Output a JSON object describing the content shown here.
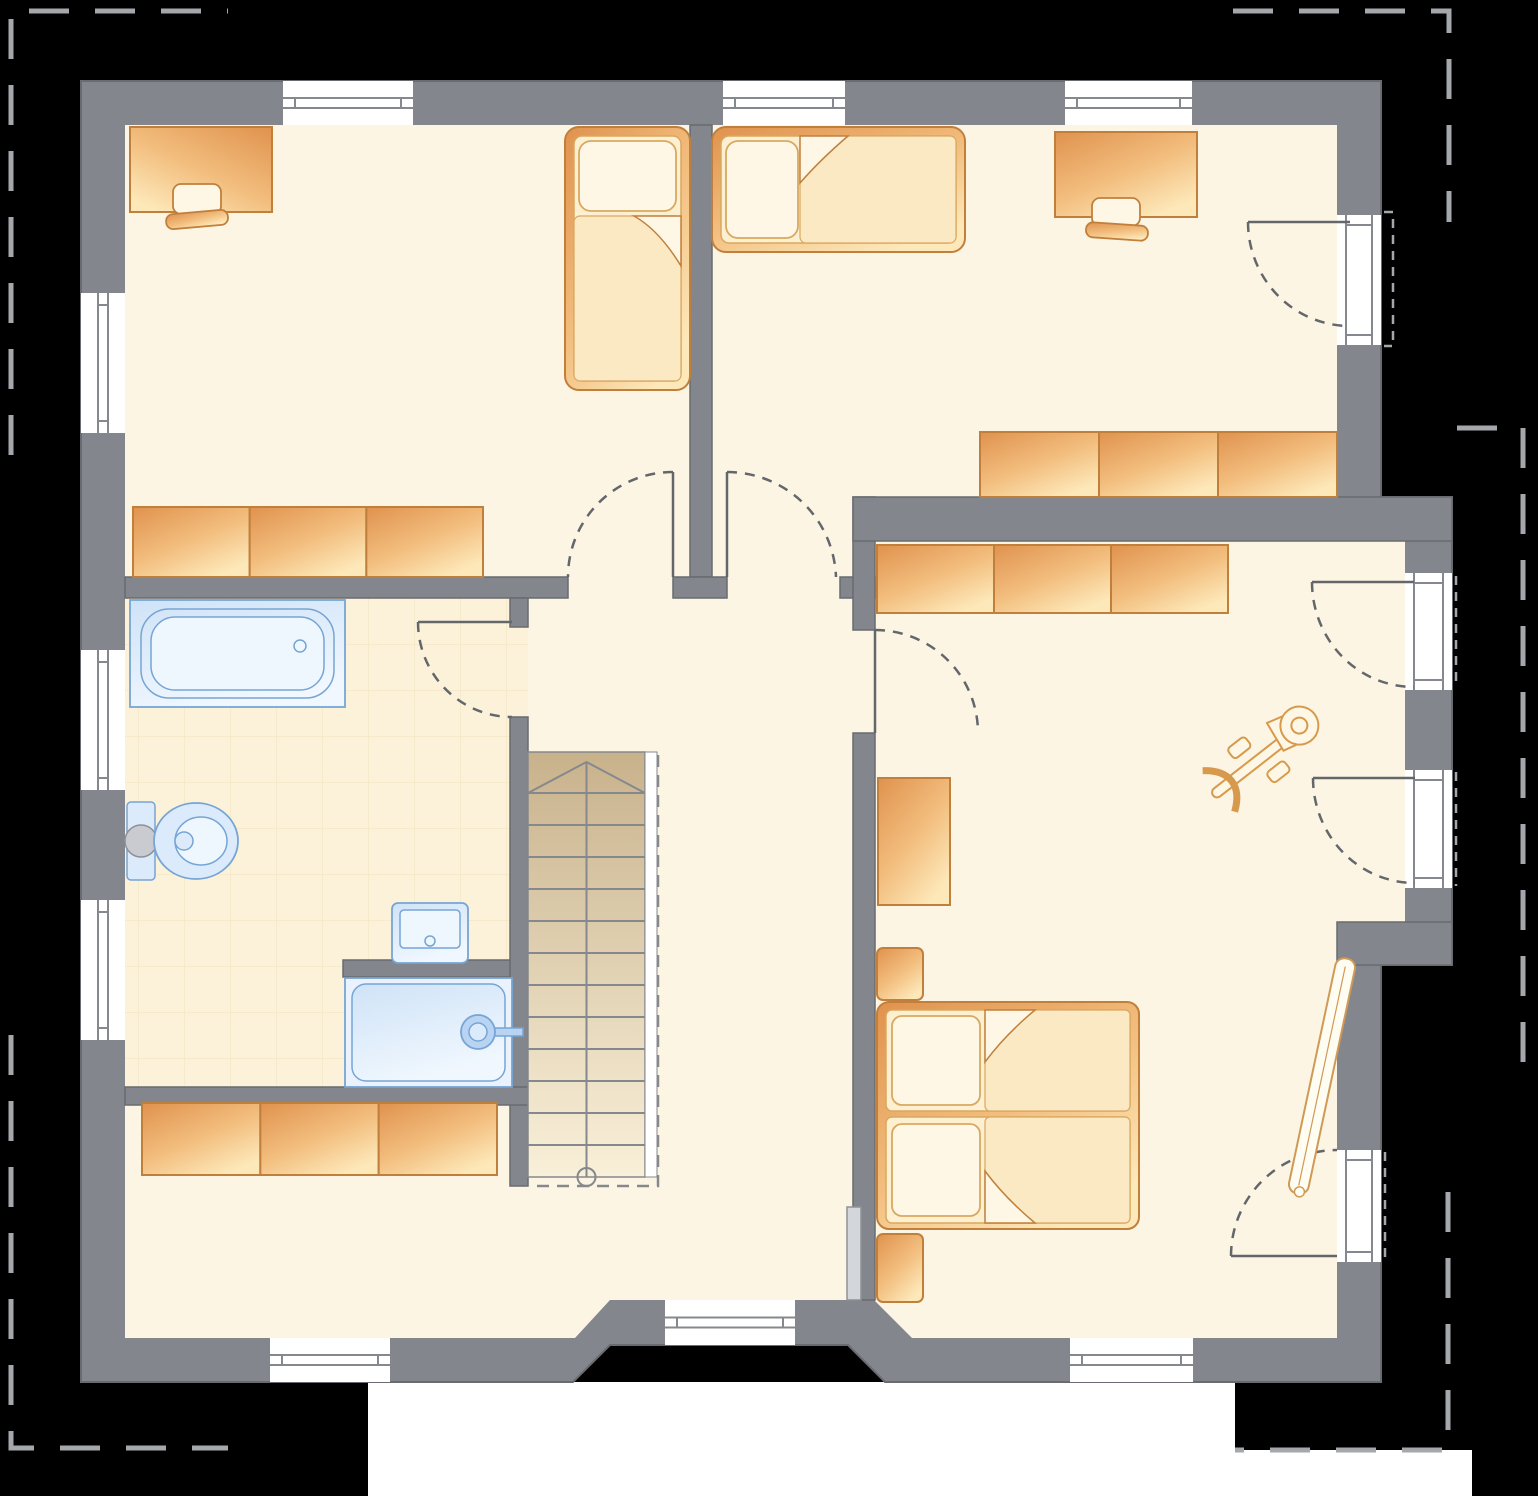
{
  "title_text": "",
  "visible_text": [],
  "colors": {
    "background": "#000000",
    "page_band": "#ffffff",
    "wall": "#83868c",
    "wall_outline": "#686b70",
    "floor": "#fdf5e3",
    "floor_bathroom": "#fcf2da",
    "tile_line": "#ecdcb6",
    "furniture_dark": "#e0924e",
    "furniture_mid": "#f2bd7d",
    "furniture_light": "#fde8b9",
    "furniture_outline": "#c0803c",
    "bedding": "#fdf0d0",
    "blanket": "#fbe9c4",
    "pillow": "#fef7e6",
    "fixture_fill": "#dcebfc",
    "fixture_fill_light": "#eef6fe",
    "fixture_stroke": "#76a5d5",
    "metal_gray": "#c9cbd0",
    "stairs_dark": "#c8b28c",
    "stairs_light": "#f9f0d9",
    "stair_line": "#85888d",
    "swing_arc_dash": "#63666b",
    "roof_outline_dash": "#a4a7ab",
    "window_glyph_line": "#85888e"
  },
  "plan": {
    "windows": [
      {
        "x": 283,
        "y": 81,
        "w": 130,
        "h": 44,
        "o": "h"
      },
      {
        "x": 723,
        "y": 81,
        "w": 122,
        "h": 44,
        "o": "h"
      },
      {
        "x": 1065,
        "y": 81,
        "w": 127,
        "h": 44,
        "o": "h"
      },
      {
        "x": 81,
        "y": 293,
        "w": 44,
        "h": 140,
        "o": "v"
      },
      {
        "x": 81,
        "y": 650,
        "w": 44,
        "h": 140,
        "o": "v"
      },
      {
        "x": 81,
        "y": 900,
        "w": 44,
        "h": 140,
        "o": "v"
      },
      {
        "x": 270,
        "y": 1338,
        "w": 120,
        "h": 44,
        "o": "h"
      },
      {
        "x": 665,
        "y": 1300,
        "w": 130,
        "h": 45,
        "o": "h"
      },
      {
        "x": 1070,
        "y": 1338,
        "w": 123,
        "h": 44,
        "o": "h"
      }
    ],
    "balcony_doors": [
      {
        "x": 1337,
        "y": 215,
        "w": 44,
        "h": 130
      },
      {
        "x": 1405,
        "y": 573,
        "w": 47,
        "h": 117
      },
      {
        "x": 1405,
        "y": 770,
        "w": 47,
        "h": 118
      },
      {
        "x": 1337,
        "y": 1150,
        "w": 44,
        "h": 112
      }
    ],
    "sideboards": [
      {
        "x": 133,
        "y": 507,
        "w": 350,
        "h": 70,
        "segs": 3
      },
      {
        "x": 980,
        "y": 432,
        "w": 357,
        "h": 65,
        "segs": 3
      },
      {
        "x": 877,
        "y": 545,
        "w": 351,
        "h": 68,
        "segs": 3
      },
      {
        "x": 142,
        "y": 1103,
        "w": 355,
        "h": 72,
        "segs": 3
      }
    ],
    "stairs": {
      "x": 528,
      "y": 752,
      "w": 117,
      "h": 425,
      "treads": 13,
      "rail_x": 658
    },
    "fixtures": [
      "bathtub",
      "toilet",
      "washbasin",
      "shower",
      "staircase",
      "single-bed",
      "single-bed",
      "double-bed",
      "desk",
      "desk-chair",
      "desk",
      "desk-chair",
      "sideboard",
      "sideboard",
      "sideboard",
      "sideboard",
      "wardrobe",
      "nightstand",
      "nightstand",
      "exercise-bike",
      "ironing-board"
    ],
    "window_count": 9,
    "balcony_door_count": 4,
    "interior_door_arc_count": 5
  }
}
